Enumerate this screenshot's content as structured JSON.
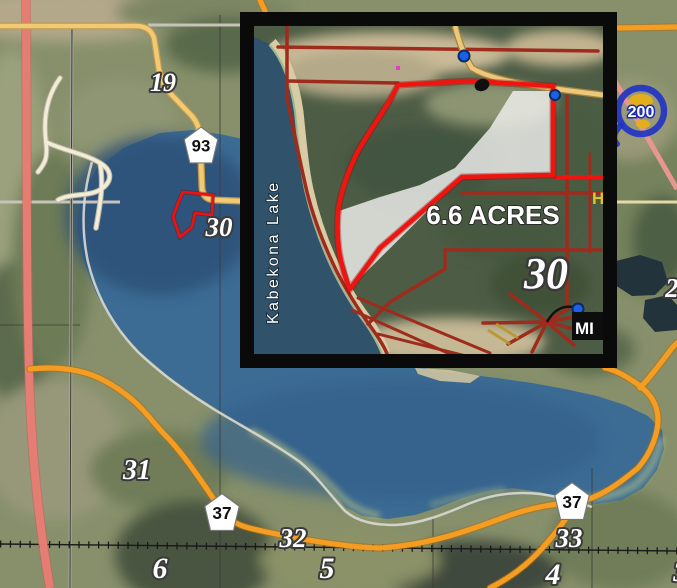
{
  "title": "Aerial map of Kabekona Lake with 6.6 acre parcel inset",
  "main_map": {
    "plss_section_labels": [
      {
        "text": "19"
      },
      {
        "text": "30"
      },
      {
        "text": "31"
      },
      {
        "text": "32"
      },
      {
        "text": "33"
      },
      {
        "text": "6"
      },
      {
        "text": "5"
      },
      {
        "text": "4"
      },
      {
        "text": "2"
      },
      {
        "text": "3"
      }
    ],
    "county_road_shields": [
      {
        "number": "93"
      },
      {
        "number": "37"
      },
      {
        "number": "37"
      }
    ],
    "state_highway_marker": {
      "number": "200"
    }
  },
  "inset": {
    "lake_label": "Kabekona  Lake",
    "acreage_label": "6.6 ACRES",
    "section_label": "30",
    "edge_label": "H",
    "marker_label": "MI"
  },
  "colors": {
    "water": "#3c6c94",
    "inset_water": "#30526b",
    "parcel_boundary": "#ee1511",
    "orange_road": "#f49d22",
    "yellow_road": "#f2ca74",
    "pink_highway": "#e57d72",
    "dark_red_road": "#9e2b1c",
    "frame": "#0a0a0a"
  }
}
